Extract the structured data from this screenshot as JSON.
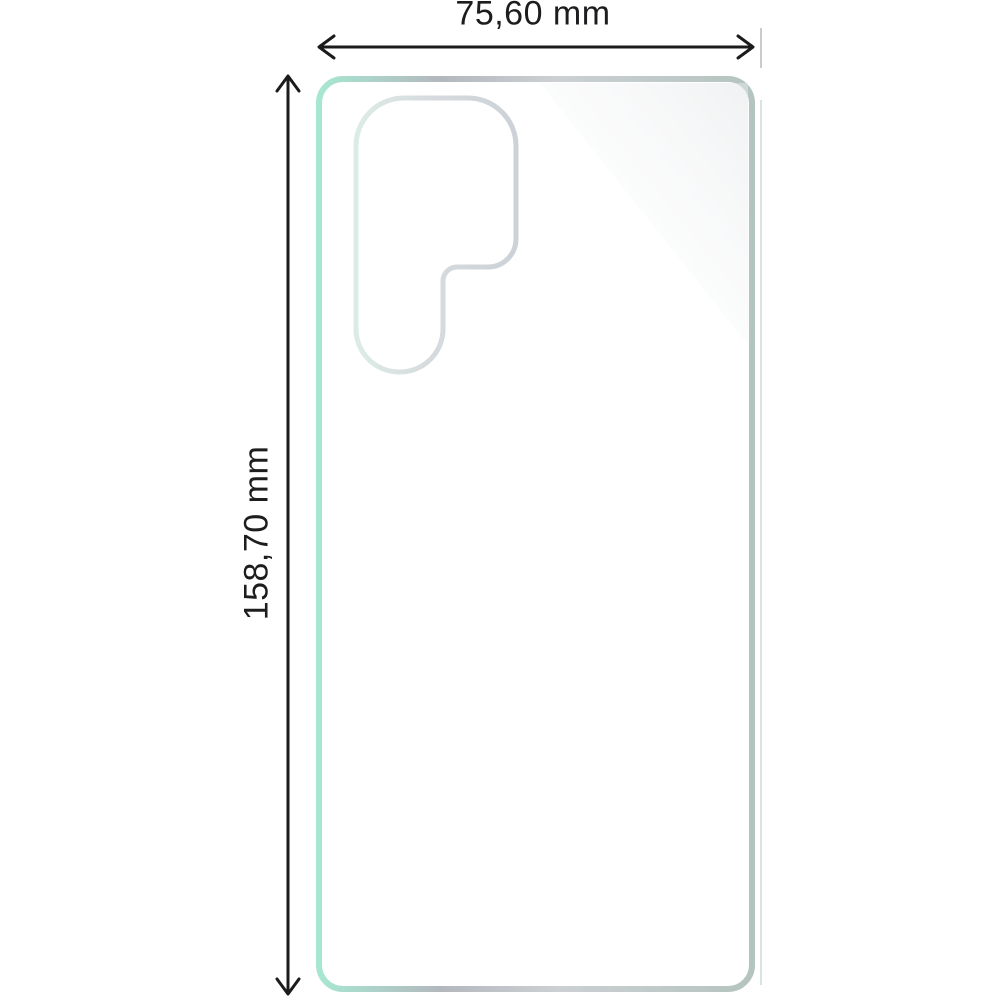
{
  "diagram": {
    "kind": "phone-film-dimension-diagram",
    "width_label": "75,60 mm",
    "height_label": "158,70 mm"
  },
  "colors": {
    "background": "#ffffff",
    "text": "#1d1d1f",
    "arrow": "#1b1b1b",
    "tick": "#c9cdd0",
    "film_mint": "#a7e7d2",
    "film_gray": "#b3b8bd",
    "film_gray_light": "#ccd0d3",
    "film_teal_gray": "#b4c4bf",
    "cutout_mint": "#dcece4",
    "cutout_gray_mid": "#d7dbdf",
    "cutout_gray": "#ccd2d7",
    "edge_highlight": "#d9e6e0",
    "sheen": "#e4e7e9"
  }
}
